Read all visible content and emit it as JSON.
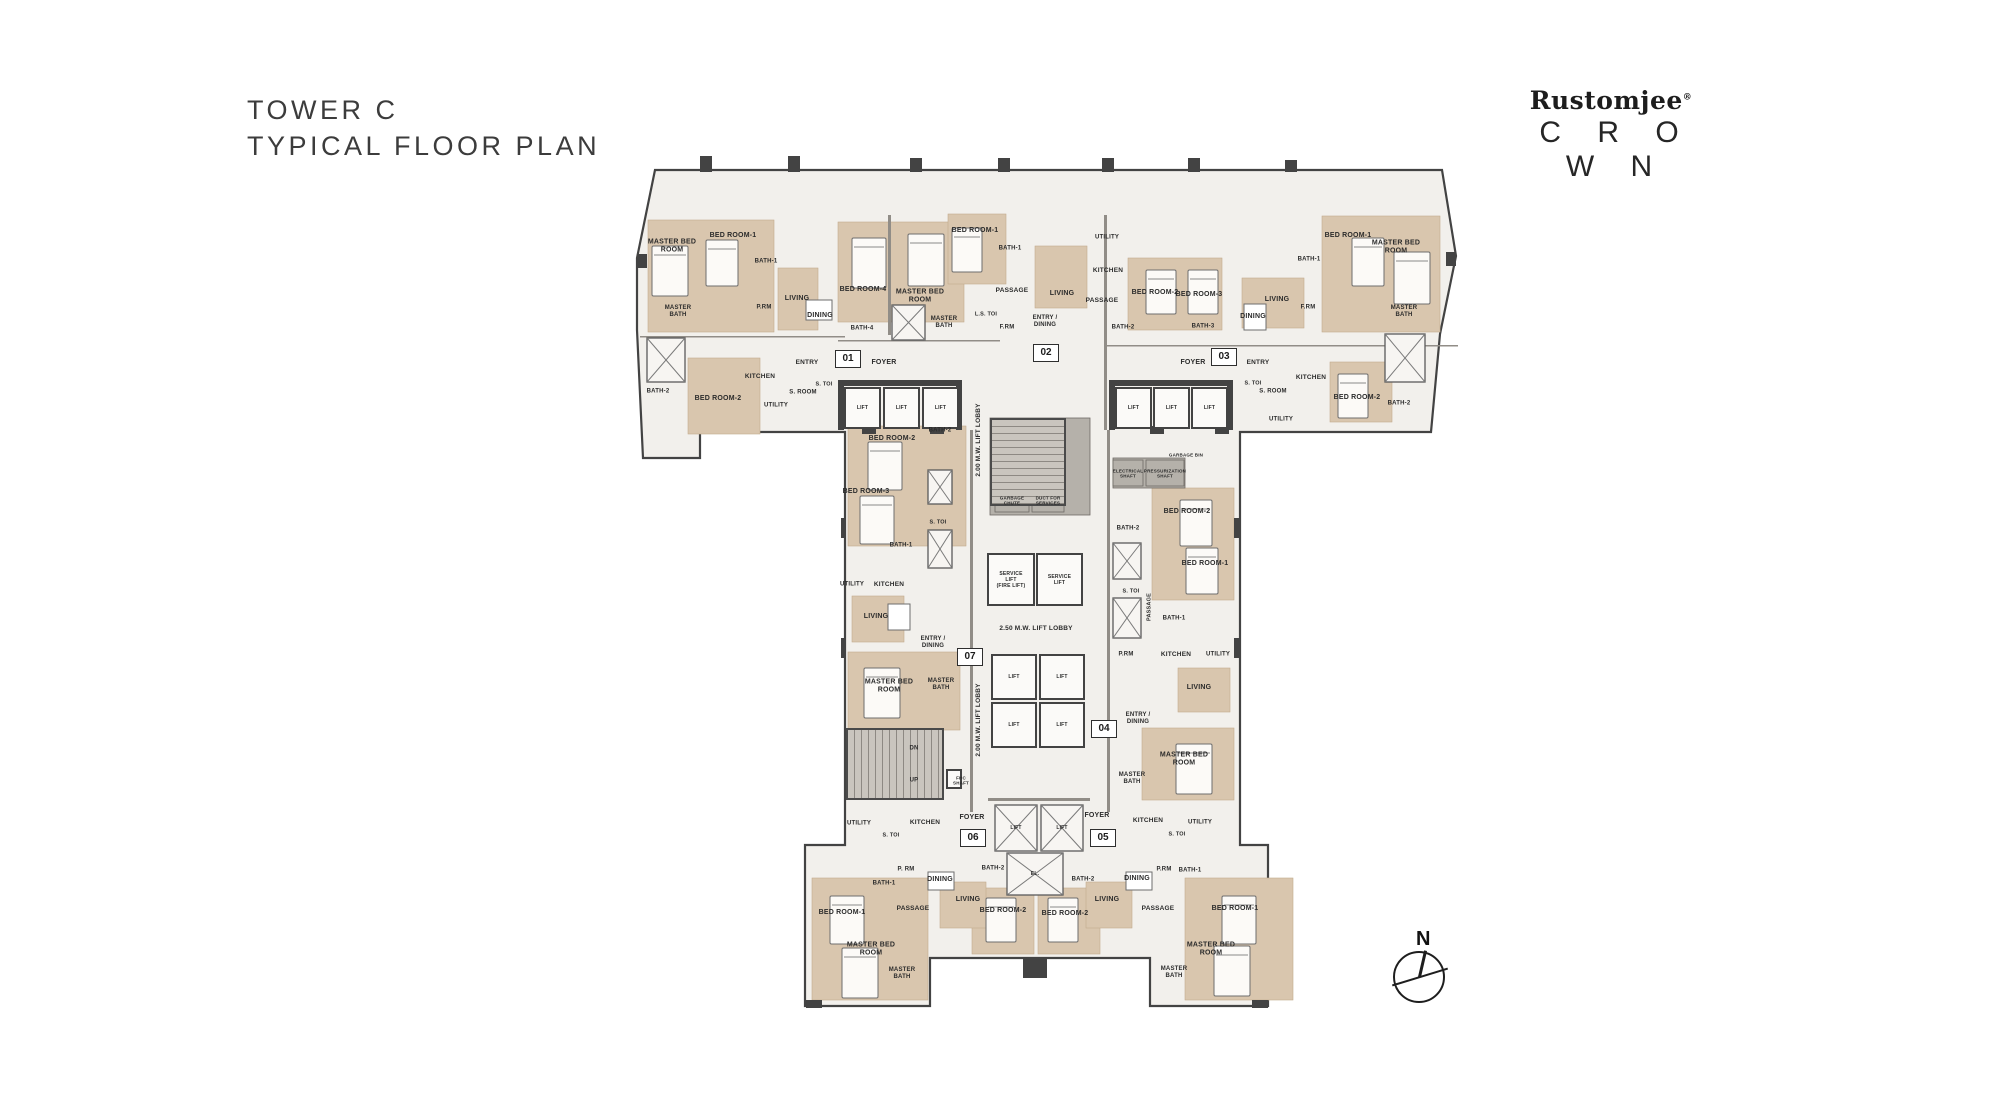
{
  "header": {
    "title_line1": "TOWER C",
    "title_line2": "TYPICAL FLOOR PLAN"
  },
  "brand": {
    "name": "Rustomjee",
    "reg": "®",
    "product": "C R O W N"
  },
  "compass": {
    "label": "N"
  },
  "plan": {
    "colors": {
      "base": "#f2f0ec",
      "wood": "#d9c6ae",
      "wall": "#434343",
      "gray": "#b5b1aa",
      "white": "#fbfaf8",
      "partition": "#918d87",
      "bed": "#fcfaf7"
    },
    "outline": "M 655 170 L 1442 170 L 1456 256 L 1440 334 L 1431 432 L 1240 432 L 1240 845 L 1268 845 L 1268 1006 L 1150 1006 L 1150 958 L 930 958 L 930 1006 L 805 1006 L 805 845 L 845 845 L 845 432 L 700 432 L 700 458 L 643 458 L 637 330 L 637 258 Z",
    "wood_zones": [
      [
        648,
        220,
        126,
        112
      ],
      [
        688,
        358,
        72,
        76
      ],
      [
        838,
        222,
        126,
        100
      ],
      [
        948,
        214,
        58,
        70
      ],
      [
        1128,
        258,
        94,
        72
      ],
      [
        1322,
        216,
        118,
        116
      ],
      [
        1330,
        362,
        62,
        60
      ],
      [
        848,
        426,
        118,
        120
      ],
      [
        848,
        652,
        112,
        78
      ],
      [
        1152,
        488,
        82,
        112
      ],
      [
        1142,
        728,
        92,
        72
      ],
      [
        812,
        878,
        116,
        122
      ],
      [
        972,
        888,
        62,
        66
      ],
      [
        1038,
        888,
        62,
        66
      ],
      [
        1185,
        878,
        108,
        122
      ],
      [
        1035,
        246,
        52,
        62
      ],
      [
        778,
        268,
        40,
        62
      ],
      [
        1242,
        278,
        62,
        50
      ],
      [
        852,
        596,
        52,
        46
      ],
      [
        1178,
        668,
        52,
        44
      ],
      [
        940,
        882,
        46,
        46
      ],
      [
        1086,
        882,
        46,
        46
      ]
    ],
    "gray_zones": [
      [
        990,
        418,
        100,
        97
      ],
      [
        1113,
        458,
        72,
        30
      ],
      [
        995,
        490,
        34,
        22
      ],
      [
        1032,
        490,
        32,
        22
      ],
      [
        1113,
        460,
        30,
        26
      ],
      [
        1146,
        460,
        38,
        26
      ]
    ],
    "stairs": [
      {
        "x": 990,
        "y": 418,
        "w": 76,
        "h": 88,
        "dir": "h-steps"
      },
      {
        "x": 846,
        "y": 728,
        "w": 98,
        "h": 72,
        "dir": "v-steps"
      }
    ],
    "partitions": [
      [
        888,
        215,
        3,
        120
      ],
      [
        1104,
        215,
        3,
        215
      ],
      [
        970,
        430,
        3,
        382
      ],
      [
        1107,
        430,
        3,
        382
      ],
      [
        640,
        336,
        205,
        1.5
      ],
      [
        838,
        340,
        162,
        1.5
      ],
      [
        1105,
        345,
        353,
        1.5
      ],
      [
        988,
        798,
        102,
        3
      ]
    ],
    "walls": [
      [
        840,
        380,
        122,
        6
      ],
      [
        838,
        380,
        6,
        50
      ],
      [
        956,
        380,
        6,
        50
      ],
      [
        1111,
        380,
        122,
        6
      ],
      [
        1109,
        380,
        6,
        50
      ],
      [
        1227,
        380,
        6,
        50
      ],
      [
        700,
        156,
        12,
        16
      ],
      [
        788,
        156,
        12,
        16
      ],
      [
        910,
        158,
        12,
        14
      ],
      [
        998,
        158,
        12,
        14
      ],
      [
        1102,
        158,
        12,
        14
      ],
      [
        1188,
        158,
        12,
        14
      ],
      [
        1285,
        160,
        12,
        12
      ],
      [
        637,
        254,
        10,
        14
      ],
      [
        1446,
        252,
        10,
        14
      ],
      [
        841,
        518,
        5,
        20
      ],
      [
        841,
        638,
        5,
        20
      ],
      [
        1234,
        518,
        5,
        20
      ],
      [
        1234,
        638,
        5,
        20
      ],
      [
        1023,
        958,
        24,
        20
      ],
      [
        806,
        1000,
        16,
        8
      ],
      [
        1252,
        1000,
        16,
        8
      ],
      [
        862,
        426,
        14,
        8
      ],
      [
        930,
        426,
        14,
        8
      ],
      [
        1150,
        426,
        14,
        8
      ],
      [
        1215,
        426,
        14,
        8
      ]
    ],
    "lifts": [
      [
        845,
        388,
        35,
        40,
        "LIFT"
      ],
      [
        884,
        388,
        35,
        40,
        "LIFT"
      ],
      [
        923,
        388,
        35,
        40,
        "LIFT"
      ],
      [
        1116,
        388,
        35,
        40,
        "LIFT"
      ],
      [
        1154,
        388,
        35,
        40,
        "LIFT"
      ],
      [
        1192,
        388,
        35,
        40,
        "LIFT"
      ],
      [
        988,
        554,
        46,
        51,
        "SERVICE\nLIFT\n(FIRE LIFT)"
      ],
      [
        1037,
        554,
        45,
        51,
        "SERVICE\nLIFT"
      ],
      [
        992,
        655,
        44,
        44,
        "LIFT"
      ],
      [
        1040,
        655,
        44,
        44,
        "LIFT"
      ],
      [
        992,
        703,
        44,
        44,
        "LIFT"
      ],
      [
        1040,
        703,
        44,
        44,
        "LIFT"
      ],
      [
        947,
        770,
        14,
        18,
        ""
      ]
    ],
    "xshafts": [
      [
        995,
        805,
        42,
        46,
        "LIFT"
      ],
      [
        1041,
        805,
        42,
        46,
        "LIFT"
      ],
      [
        1007,
        853,
        56,
        42,
        "EL."
      ],
      [
        647,
        338,
        38,
        44,
        ""
      ],
      [
        892,
        305,
        33,
        35,
        ""
      ],
      [
        928,
        470,
        24,
        34,
        ""
      ],
      [
        928,
        530,
        24,
        38,
        ""
      ],
      [
        1113,
        543,
        28,
        36,
        ""
      ],
      [
        1113,
        598,
        28,
        40,
        ""
      ],
      [
        1385,
        334,
        40,
        48,
        ""
      ]
    ],
    "beds": [
      [
        652,
        246,
        36,
        50
      ],
      [
        706,
        240,
        32,
        46
      ],
      [
        852,
        238,
        34,
        50
      ],
      [
        908,
        234,
        36,
        52
      ],
      [
        952,
        228,
        30,
        44
      ],
      [
        1146,
        270,
        30,
        44
      ],
      [
        1188,
        270,
        30,
        44
      ],
      [
        1352,
        238,
        32,
        48
      ],
      [
        1394,
        252,
        36,
        52
      ],
      [
        1338,
        374,
        30,
        44
      ],
      [
        868,
        442,
        34,
        48
      ],
      [
        860,
        496,
        34,
        48
      ],
      [
        1180,
        500,
        32,
        46
      ],
      [
        1186,
        548,
        32,
        46
      ],
      [
        864,
        668,
        36,
        50
      ],
      [
        1176,
        744,
        36,
        50
      ],
      [
        830,
        896,
        34,
        48
      ],
      [
        842,
        948,
        36,
        50
      ],
      [
        986,
        898,
        30,
        44
      ],
      [
        1048,
        898,
        30,
        44
      ],
      [
        1222,
        896,
        34,
        48
      ],
      [
        1214,
        946,
        36,
        50
      ]
    ],
    "tables": [
      [
        806,
        300,
        26,
        20
      ],
      [
        1244,
        304,
        22,
        26
      ],
      [
        928,
        872,
        26,
        18
      ],
      [
        1126,
        872,
        26,
        18
      ],
      [
        888,
        604,
        22,
        26
      ]
    ],
    "labels": [
      {
        "t": "MASTER BED\nROOM",
        "x": 672,
        "y": 247
      },
      {
        "t": "BED ROOM-1",
        "x": 733,
        "y": 236
      },
      {
        "t": "BATH-1",
        "x": 766,
        "y": 262,
        "s": 6
      },
      {
        "t": "MASTER\nBATH",
        "x": 678,
        "y": 312,
        "s": 6
      },
      {
        "t": "P.RM",
        "x": 764,
        "y": 308,
        "s": 6
      },
      {
        "t": "LIVING",
        "x": 797,
        "y": 299
      },
      {
        "t": "DINING",
        "x": 820,
        "y": 316
      },
      {
        "t": "BED ROOM-4",
        "x": 863,
        "y": 290
      },
      {
        "t": "BATH-4",
        "x": 862,
        "y": 329,
        "s": 6
      },
      {
        "t": "ENTRY",
        "x": 807,
        "y": 363,
        "s": 6.5
      },
      {
        "t": "FOYER",
        "x": 884,
        "y": 363
      },
      {
        "t": "KITCHEN",
        "x": 760,
        "y": 377,
        "s": 6.5
      },
      {
        "t": "S. TOI",
        "x": 824,
        "y": 385,
        "s": 5.5
      },
      {
        "t": "S. ROOM",
        "x": 803,
        "y": 393,
        "s": 6
      },
      {
        "t": "UTILITY",
        "x": 776,
        "y": 406,
        "s": 6
      },
      {
        "t": "BATH-2",
        "x": 658,
        "y": 392,
        "s": 6
      },
      {
        "t": "BED ROOM-2",
        "x": 718,
        "y": 399
      },
      {
        "t": "BED ROOM-1",
        "x": 975,
        "y": 231
      },
      {
        "t": "MASTER BED\nROOM",
        "x": 920,
        "y": 297
      },
      {
        "t": "BATH-1",
        "x": 1010,
        "y": 249,
        "s": 6
      },
      {
        "t": "PASSAGE",
        "x": 1012,
        "y": 291,
        "s": 6.5
      },
      {
        "t": "LIVING",
        "x": 1062,
        "y": 294
      },
      {
        "t": "MASTER\nBATH",
        "x": 944,
        "y": 323,
        "s": 6
      },
      {
        "t": "L.S. TOI",
        "x": 986,
        "y": 315,
        "s": 5.5
      },
      {
        "t": "F.RM",
        "x": 1007,
        "y": 328,
        "s": 6
      },
      {
        "t": "ENTRY /\nDINING",
        "x": 1045,
        "y": 322,
        "s": 6
      },
      {
        "t": "UTILITY",
        "x": 1107,
        "y": 238,
        "s": 6
      },
      {
        "t": "KITCHEN",
        "x": 1108,
        "y": 271,
        "s": 6.5
      },
      {
        "t": "PASSAGE",
        "x": 1102,
        "y": 301,
        "s": 6.5
      },
      {
        "t": "BED ROOM-2",
        "x": 1155,
        "y": 293
      },
      {
        "t": "BED ROOM-3",
        "x": 1199,
        "y": 295
      },
      {
        "t": "BATH-2",
        "x": 1123,
        "y": 328,
        "s": 6
      },
      {
        "t": "BATH-3",
        "x": 1203,
        "y": 327,
        "s": 6
      },
      {
        "t": "DINING",
        "x": 1253,
        "y": 317
      },
      {
        "t": "LIVING",
        "x": 1277,
        "y": 300
      },
      {
        "t": "BATH-1",
        "x": 1309,
        "y": 260,
        "s": 6
      },
      {
        "t": "F.RM",
        "x": 1308,
        "y": 308,
        "s": 6
      },
      {
        "t": "BED ROOM-1",
        "x": 1348,
        "y": 236
      },
      {
        "t": "MASTER BED\nROOM",
        "x": 1396,
        "y": 248
      },
      {
        "t": "MASTER\nBATH",
        "x": 1404,
        "y": 312,
        "s": 6
      },
      {
        "t": "ENTRY",
        "x": 1258,
        "y": 363,
        "s": 6.5
      },
      {
        "t": "FOYER",
        "x": 1193,
        "y": 363
      },
      {
        "t": "S. TOI",
        "x": 1253,
        "y": 384,
        "s": 5.5
      },
      {
        "t": "S. ROOM",
        "x": 1273,
        "y": 392,
        "s": 6
      },
      {
        "t": "KITCHEN",
        "x": 1311,
        "y": 378,
        "s": 6.5
      },
      {
        "t": "UTILITY",
        "x": 1281,
        "y": 420,
        "s": 6
      },
      {
        "t": "BED ROOM-2",
        "x": 1357,
        "y": 398
      },
      {
        "t": "BATH-2",
        "x": 1399,
        "y": 404,
        "s": 6
      },
      {
        "t": "2.00 M.W. LIFT LOBBY",
        "x": 979,
        "y": 440,
        "s": 6.5,
        "r": -90,
        "w": 200
      },
      {
        "t": "GARBAGE CHUTE",
        "x": 1012,
        "y": 501,
        "s": 4.5,
        "w": 30
      },
      {
        "t": "DUCT FOR\nSERVICES",
        "x": 1048,
        "y": 501,
        "s": 4.5
      },
      {
        "t": "ELECTRICAL\nSHAFT",
        "x": 1128,
        "y": 474,
        "s": 4.5
      },
      {
        "t": "PRESSURIZATION\nSHAFT",
        "x": 1165,
        "y": 474,
        "s": 4.5
      },
      {
        "t": "GARBAGE BIN",
        "x": 1186,
        "y": 455,
        "s": 4.5,
        "w": 40
      },
      {
        "t": "BED ROOM-2",
        "x": 892,
        "y": 439
      },
      {
        "t": "BATH-2",
        "x": 940,
        "y": 431,
        "s": 6
      },
      {
        "t": "BED ROOM-3",
        "x": 866,
        "y": 492
      },
      {
        "t": "S. TOI",
        "x": 938,
        "y": 523,
        "s": 5.5
      },
      {
        "t": "BATH-1",
        "x": 901,
        "y": 546,
        "s": 6
      },
      {
        "t": "UTILITY",
        "x": 852,
        "y": 585,
        "s": 6
      },
      {
        "t": "KITCHEN",
        "x": 889,
        "y": 585,
        "s": 6.5
      },
      {
        "t": "LIVING",
        "x": 876,
        "y": 617
      },
      {
        "t": "ENTRY / DINING",
        "x": 933,
        "y": 643,
        "s": 6,
        "w": 46
      },
      {
        "t": "MASTER BED\nROOM",
        "x": 889,
        "y": 687
      },
      {
        "t": "MASTER\nBATH",
        "x": 941,
        "y": 685,
        "s": 6
      },
      {
        "t": "2.50 M.W. LIFT LOBBY",
        "x": 1036,
        "y": 629,
        "s": 6.5,
        "w": 140
      },
      {
        "t": "2.00 M.W. LIFT LOBBY",
        "x": 979,
        "y": 720,
        "s": 6.5,
        "r": -90,
        "w": 200
      },
      {
        "t": "DN",
        "x": 914,
        "y": 749,
        "s": 6
      },
      {
        "t": "UP",
        "x": 914,
        "y": 781,
        "s": 6
      },
      {
        "t": "FHC\nSHAFT",
        "x": 961,
        "y": 781,
        "s": 4.5
      },
      {
        "t": "BED ROOM-2",
        "x": 1187,
        "y": 512
      },
      {
        "t": "BATH-2",
        "x": 1128,
        "y": 529,
        "s": 6
      },
      {
        "t": "BED ROOM-1",
        "x": 1205,
        "y": 564
      },
      {
        "t": "S. TOI",
        "x": 1131,
        "y": 592,
        "s": 5.5
      },
      {
        "t": "PASSAGE",
        "x": 1150,
        "y": 607,
        "s": 5.5,
        "r": -90
      },
      {
        "t": "BATH-1",
        "x": 1174,
        "y": 619,
        "s": 6
      },
      {
        "t": "P.RM",
        "x": 1126,
        "y": 655,
        "s": 6
      },
      {
        "t": "KITCHEN",
        "x": 1176,
        "y": 655,
        "s": 6.5
      },
      {
        "t": "UTILITY",
        "x": 1218,
        "y": 655,
        "s": 6
      },
      {
        "t": "LIVING",
        "x": 1199,
        "y": 688
      },
      {
        "t": "ENTRY /\nDINING",
        "x": 1138,
        "y": 719,
        "s": 6
      },
      {
        "t": "MASTER BED\nROOM",
        "x": 1184,
        "y": 760
      },
      {
        "t": "MASTER\nBATH",
        "x": 1132,
        "y": 779,
        "s": 6
      },
      {
        "t": "FOYER",
        "x": 972,
        "y": 818
      },
      {
        "t": "FOYER",
        "x": 1097,
        "y": 816
      },
      {
        "t": "UTILITY",
        "x": 859,
        "y": 824,
        "s": 6
      },
      {
        "t": "KITCHEN",
        "x": 925,
        "y": 823,
        "s": 6.5
      },
      {
        "t": "S. TOI",
        "x": 891,
        "y": 836,
        "s": 5.5
      },
      {
        "t": "P. RM",
        "x": 906,
        "y": 870,
        "s": 6
      },
      {
        "t": "BATH-1",
        "x": 884,
        "y": 884,
        "s": 6
      },
      {
        "t": "DINING",
        "x": 940,
        "y": 880
      },
      {
        "t": "LIVING",
        "x": 968,
        "y": 900
      },
      {
        "t": "PASSAGE",
        "x": 913,
        "y": 909,
        "s": 6.5
      },
      {
        "t": "BED ROOM-1",
        "x": 842,
        "y": 913
      },
      {
        "t": "BED ROOM-2",
        "x": 1003,
        "y": 911
      },
      {
        "t": "BATH-2",
        "x": 993,
        "y": 869,
        "s": 6
      },
      {
        "t": "MASTER BED\nROOM",
        "x": 871,
        "y": 950
      },
      {
        "t": "MASTER\nBATH",
        "x": 902,
        "y": 974,
        "s": 6
      },
      {
        "t": "UTILITY",
        "x": 1200,
        "y": 823,
        "s": 6
      },
      {
        "t": "KITCHEN",
        "x": 1148,
        "y": 821,
        "s": 6.5
      },
      {
        "t": "S. TOI",
        "x": 1177,
        "y": 835,
        "s": 5.5
      },
      {
        "t": "P.RM",
        "x": 1164,
        "y": 870,
        "s": 6
      },
      {
        "t": "BATH-1",
        "x": 1190,
        "y": 871,
        "s": 6
      },
      {
        "t": "BATH-2",
        "x": 1083,
        "y": 880,
        "s": 6
      },
      {
        "t": "DINING",
        "x": 1137,
        "y": 879
      },
      {
        "t": "LIVING",
        "x": 1107,
        "y": 900
      },
      {
        "t": "PASSAGE",
        "x": 1158,
        "y": 909,
        "s": 6.5
      },
      {
        "t": "BED ROOM-2",
        "x": 1065,
        "y": 914
      },
      {
        "t": "BED ROOM-1",
        "x": 1235,
        "y": 909
      },
      {
        "t": "MASTER BED\nROOM",
        "x": 1211,
        "y": 950
      },
      {
        "t": "MASTER\nBATH",
        "x": 1174,
        "y": 973,
        "s": 6
      }
    ],
    "badges": [
      [
        "01",
        848,
        359
      ],
      [
        "02",
        1046,
        353
      ],
      [
        "03",
        1224,
        357
      ],
      [
        "04",
        1104,
        729
      ],
      [
        "05",
        1103,
        838
      ],
      [
        "06",
        973,
        838
      ],
      [
        "07",
        970,
        657
      ]
    ]
  }
}
